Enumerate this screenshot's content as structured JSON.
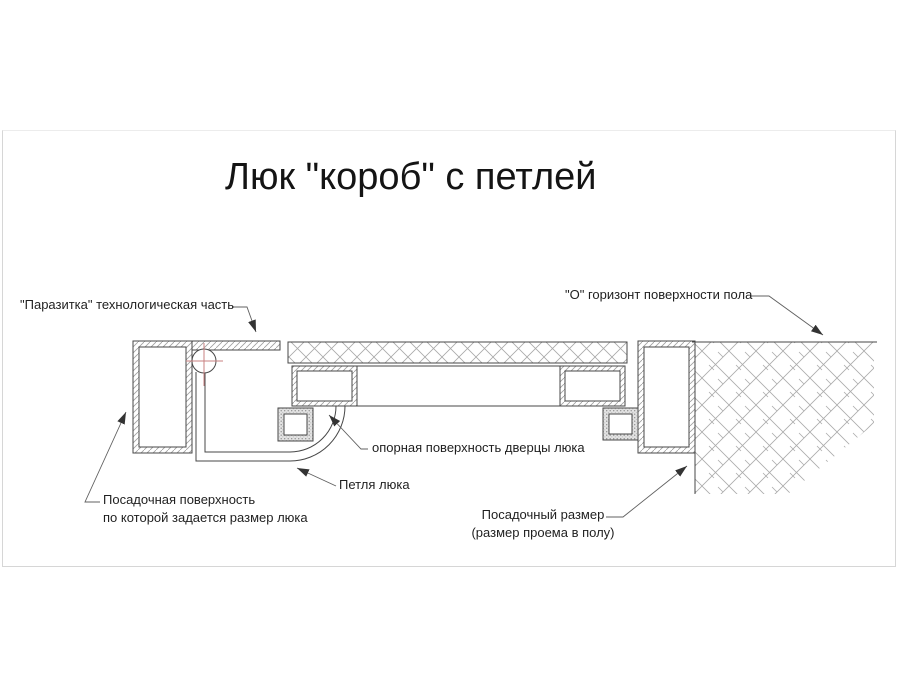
{
  "title": "Люк \"короб\" с петлей",
  "labels": {
    "parasitka": "\"Паразитка\" технологическая часть",
    "floor_horizon": "\"О\" горизонт поверхности пола",
    "door_bearing_surface": "опорная поверхность дверцы люка",
    "hinge": "Петля люка",
    "seating_surface_line1": "Посадочная поверхность",
    "seating_surface_line2": "по которой задается размер люка",
    "seating_size_line1": "Посадочный размер",
    "seating_size_line2": "(размер проема в полу)"
  },
  "colors": {
    "background": "#ffffff",
    "line": "#474747",
    "hatch": "#a5a5a5",
    "centerline_red": "#c98080",
    "leader": "#606060",
    "image_border": "#d6d6d6"
  }
}
